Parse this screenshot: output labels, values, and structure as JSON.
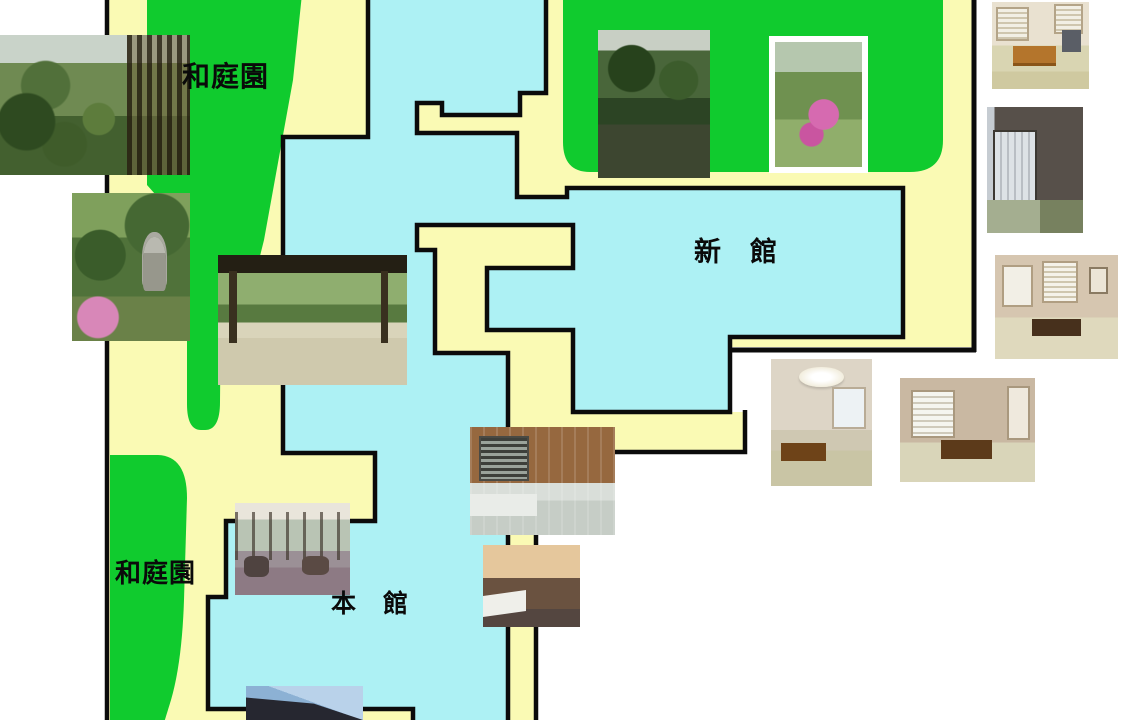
{
  "map": {
    "colors": {
      "background": "#ffffff",
      "ground": "#FAFAB4",
      "building": "#ADF1F4",
      "garden": "#10CB2E",
      "outline": "#0B0B0B",
      "label_text": "#0A0A0A"
    },
    "labels": {
      "garden_top": "和庭園",
      "garden_bottom": "和庭園",
      "new_wing": "新　館",
      "main_wing": "本　館"
    },
    "areas": [
      {
        "name": "japanese-garden-upper-left",
        "label": "和庭園",
        "type": "garden"
      },
      {
        "name": "japanese-garden-upper-right",
        "label": "",
        "type": "garden"
      },
      {
        "name": "japanese-garden-lower-left",
        "label": "和庭園",
        "type": "garden"
      },
      {
        "name": "new-wing-building",
        "label": "新　館",
        "type": "building"
      },
      {
        "name": "main-wing-building",
        "label": "本　館",
        "type": "building"
      },
      {
        "name": "grounds",
        "label": "",
        "type": "ground"
      }
    ],
    "photos": [
      {
        "name": "garden-panorama-photo"
      },
      {
        "name": "stone-lantern-garden-photo"
      },
      {
        "name": "engawa-garden-view-photo"
      },
      {
        "name": "new-wing-garden-photo"
      },
      {
        "name": "azalea-garden-photo"
      },
      {
        "name": "tiled-bath-photo"
      },
      {
        "name": "bathtub-photo"
      },
      {
        "name": "guest-room-pendant-lamp-photo"
      },
      {
        "name": "guest-room-wide-photo"
      },
      {
        "name": "roof-sky-photo"
      },
      {
        "name": "guest-room-low-table-photo"
      },
      {
        "name": "guest-room-shoji-photo"
      },
      {
        "name": "guest-room-corner-photo"
      },
      {
        "name": "lobby-lounge-photo"
      }
    ]
  }
}
